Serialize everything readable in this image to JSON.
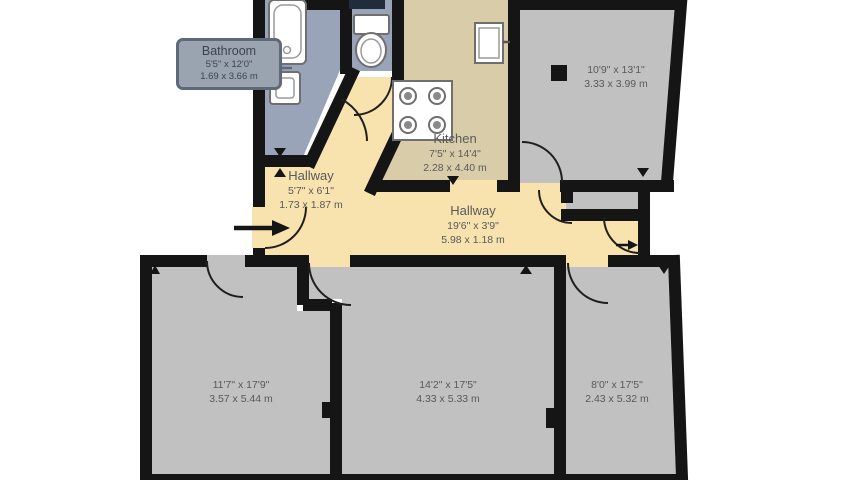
{
  "floorplan": {
    "callout": {
      "room_name": "Bathroom",
      "dimensions_imperial": "5'5\" x 12'0\"",
      "dimensions_metric": "1.69 x 3.66 m"
    },
    "kitchen": {
      "name": "Kitchen",
      "dimensions_imperial": "7'5\" x 14'4\"",
      "dimensions_metric": "2.28 x 4.40 m"
    },
    "hallway_small": {
      "name": "Hallway",
      "dimensions_imperial": "5'7\" x 6'1\"",
      "dimensions_metric": "1.73 x 1.87 m"
    },
    "hallway_long": {
      "name": "Hallway",
      "dimensions_imperial": "19'6\" x 3'9\"",
      "dimensions_metric": "5.98 x 1.18 m"
    },
    "room_top_right": {
      "dimensions_imperial": "10'9\" x 13'1\"",
      "dimensions_metric": "3.33 x 3.99 m"
    },
    "room_bottom_left": {
      "dimensions_imperial": "11'7\" x 17'9\"",
      "dimensions_metric": "3.57 x 5.44 m"
    },
    "room_bottom_middle": {
      "dimensions_imperial": "14'2\" x 17'5\"",
      "dimensions_metric": "4.33 x 5.33 m"
    },
    "room_bottom_right": {
      "dimensions_imperial": "8'0\" x 17'5\"",
      "dimensions_metric": "2.43 x 5.32 m"
    },
    "icons": [
      "bathtub",
      "sink",
      "toilet",
      "stove",
      "refrigerator",
      "window",
      "entrance-arrow",
      "room-area-marker",
      "wall-marker"
    ],
    "colors": {
      "background": "#ffffff",
      "wall": "#151515",
      "room_floor": "#c1c1c1",
      "bathroom_floor": "#9aa4b8",
      "kitchen_floor": "#d9cda9",
      "hallway_floor": "#f8e3af",
      "label_text": "#58595b",
      "callout_bg": "#9aa3b0",
      "callout_border": "#5f6a78"
    }
  }
}
